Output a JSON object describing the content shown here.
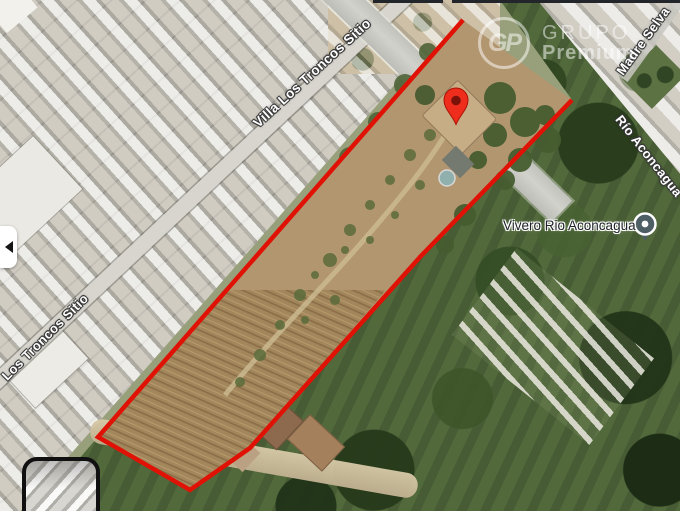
{
  "streets": {
    "villa_los_troncos": "Villa Los Troncos Sitio",
    "los_troncos": "Los Troncos Sitio",
    "madre_selva": "Madre Selva",
    "rio_aconcagua": "Río Aconcagua"
  },
  "poi": {
    "name": "Vivero Rio Aconcagua"
  },
  "watermark": {
    "monogram": "GP",
    "brand_line1": "GRUPO",
    "brand_line2": "Premium"
  },
  "icons": {
    "prev_arrow": "black-left-triangle",
    "red_pin": "red-map-pin",
    "poi_marker": "dark-gray-circle-pin",
    "thumbnail_glyph": "white-rounded-square-outline"
  },
  "colors": {
    "boundary_red": "#e01205",
    "pin_red": "#ee2d1c",
    "poi_gray": "#4d5f64"
  }
}
